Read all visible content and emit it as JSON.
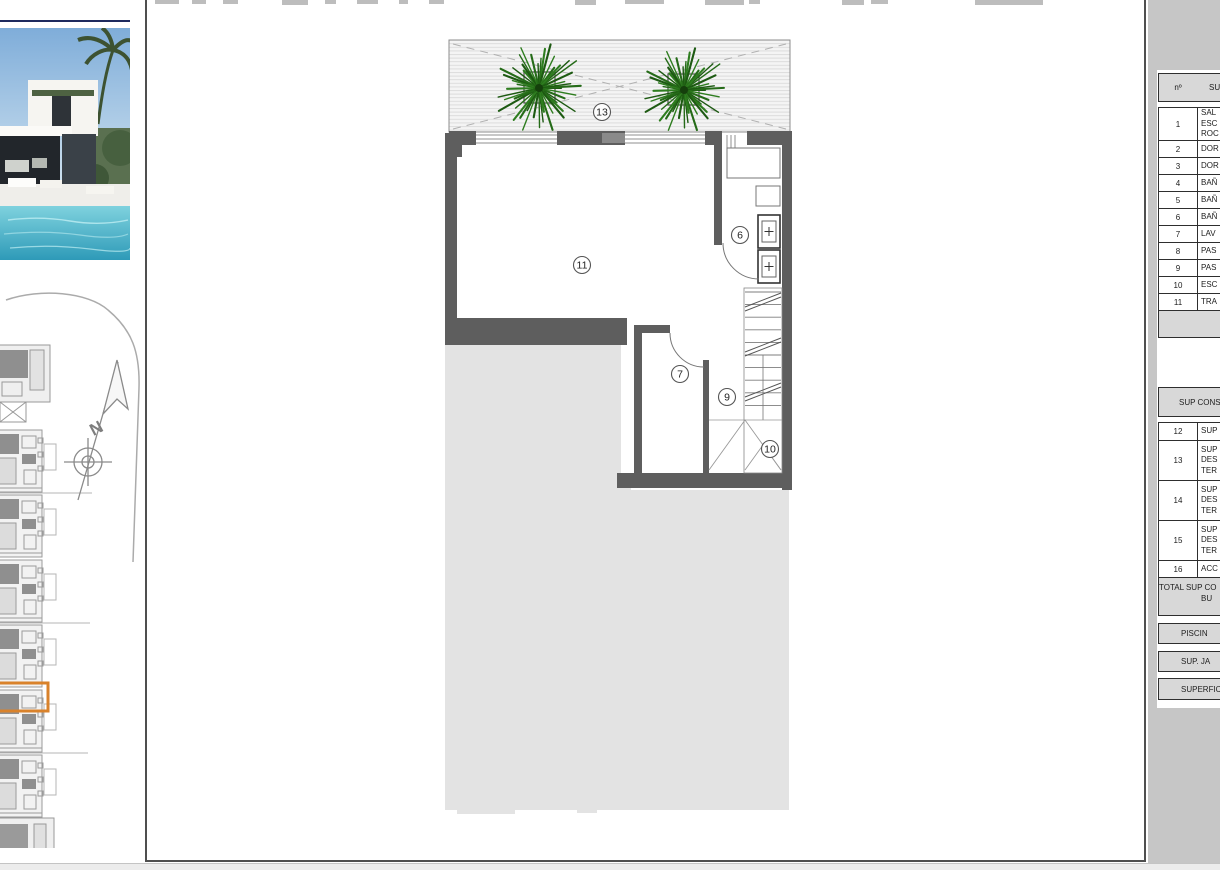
{
  "colors": {
    "accent_orange": "#D9822B",
    "wall_gray": "#5E5E5E",
    "tree_green": "#2E7D1F",
    "plot_fill": "#E3E3E3",
    "panel_bg": "#C6C6C6",
    "table_bar_bg": "#D8D8D8"
  },
  "plan": {
    "labels": [
      {
        "num": "13"
      },
      {
        "num": "11"
      },
      {
        "num": "6"
      },
      {
        "num": "7"
      },
      {
        "num": "9"
      },
      {
        "num": "10"
      }
    ]
  },
  "surface_table": {
    "header": {
      "num_col": "nº",
      "sup_col": "SUP"
    },
    "rows": [
      {
        "num": "1",
        "label": "SAL\nESC\nROC"
      },
      {
        "num": "2",
        "label": "DOR"
      },
      {
        "num": "3",
        "label": "DOR"
      },
      {
        "num": "4",
        "label": "BAÑ"
      },
      {
        "num": "5",
        "label": "BAÑ"
      },
      {
        "num": "6",
        "label": "BAÑ"
      },
      {
        "num": "7",
        "label": "LAV"
      },
      {
        "num": "8",
        "label": "PAS"
      },
      {
        "num": "9",
        "label": "PAS"
      },
      {
        "num": "10",
        "label": "ESC"
      },
      {
        "num": "11",
        "label": "TRA"
      }
    ]
  },
  "construction_table": {
    "header": "SUP CONS",
    "rows": [
      {
        "num": "12",
        "label": "SUP"
      },
      {
        "num": "13",
        "label": "SUP\nDES\nTER"
      },
      {
        "num": "14",
        "label": "SUP\nDES\nTER"
      },
      {
        "num": "15",
        "label": "SUP\nDES\nTER"
      },
      {
        "num": "16",
        "label": "ACC"
      }
    ],
    "total_line1": "TOTAL SUP CO",
    "total_line2": "BU"
  },
  "summary_bars": [
    {
      "label": "PISCIN"
    },
    {
      "label": "SUP. JA"
    },
    {
      "label": "SUPERFIC"
    }
  ]
}
